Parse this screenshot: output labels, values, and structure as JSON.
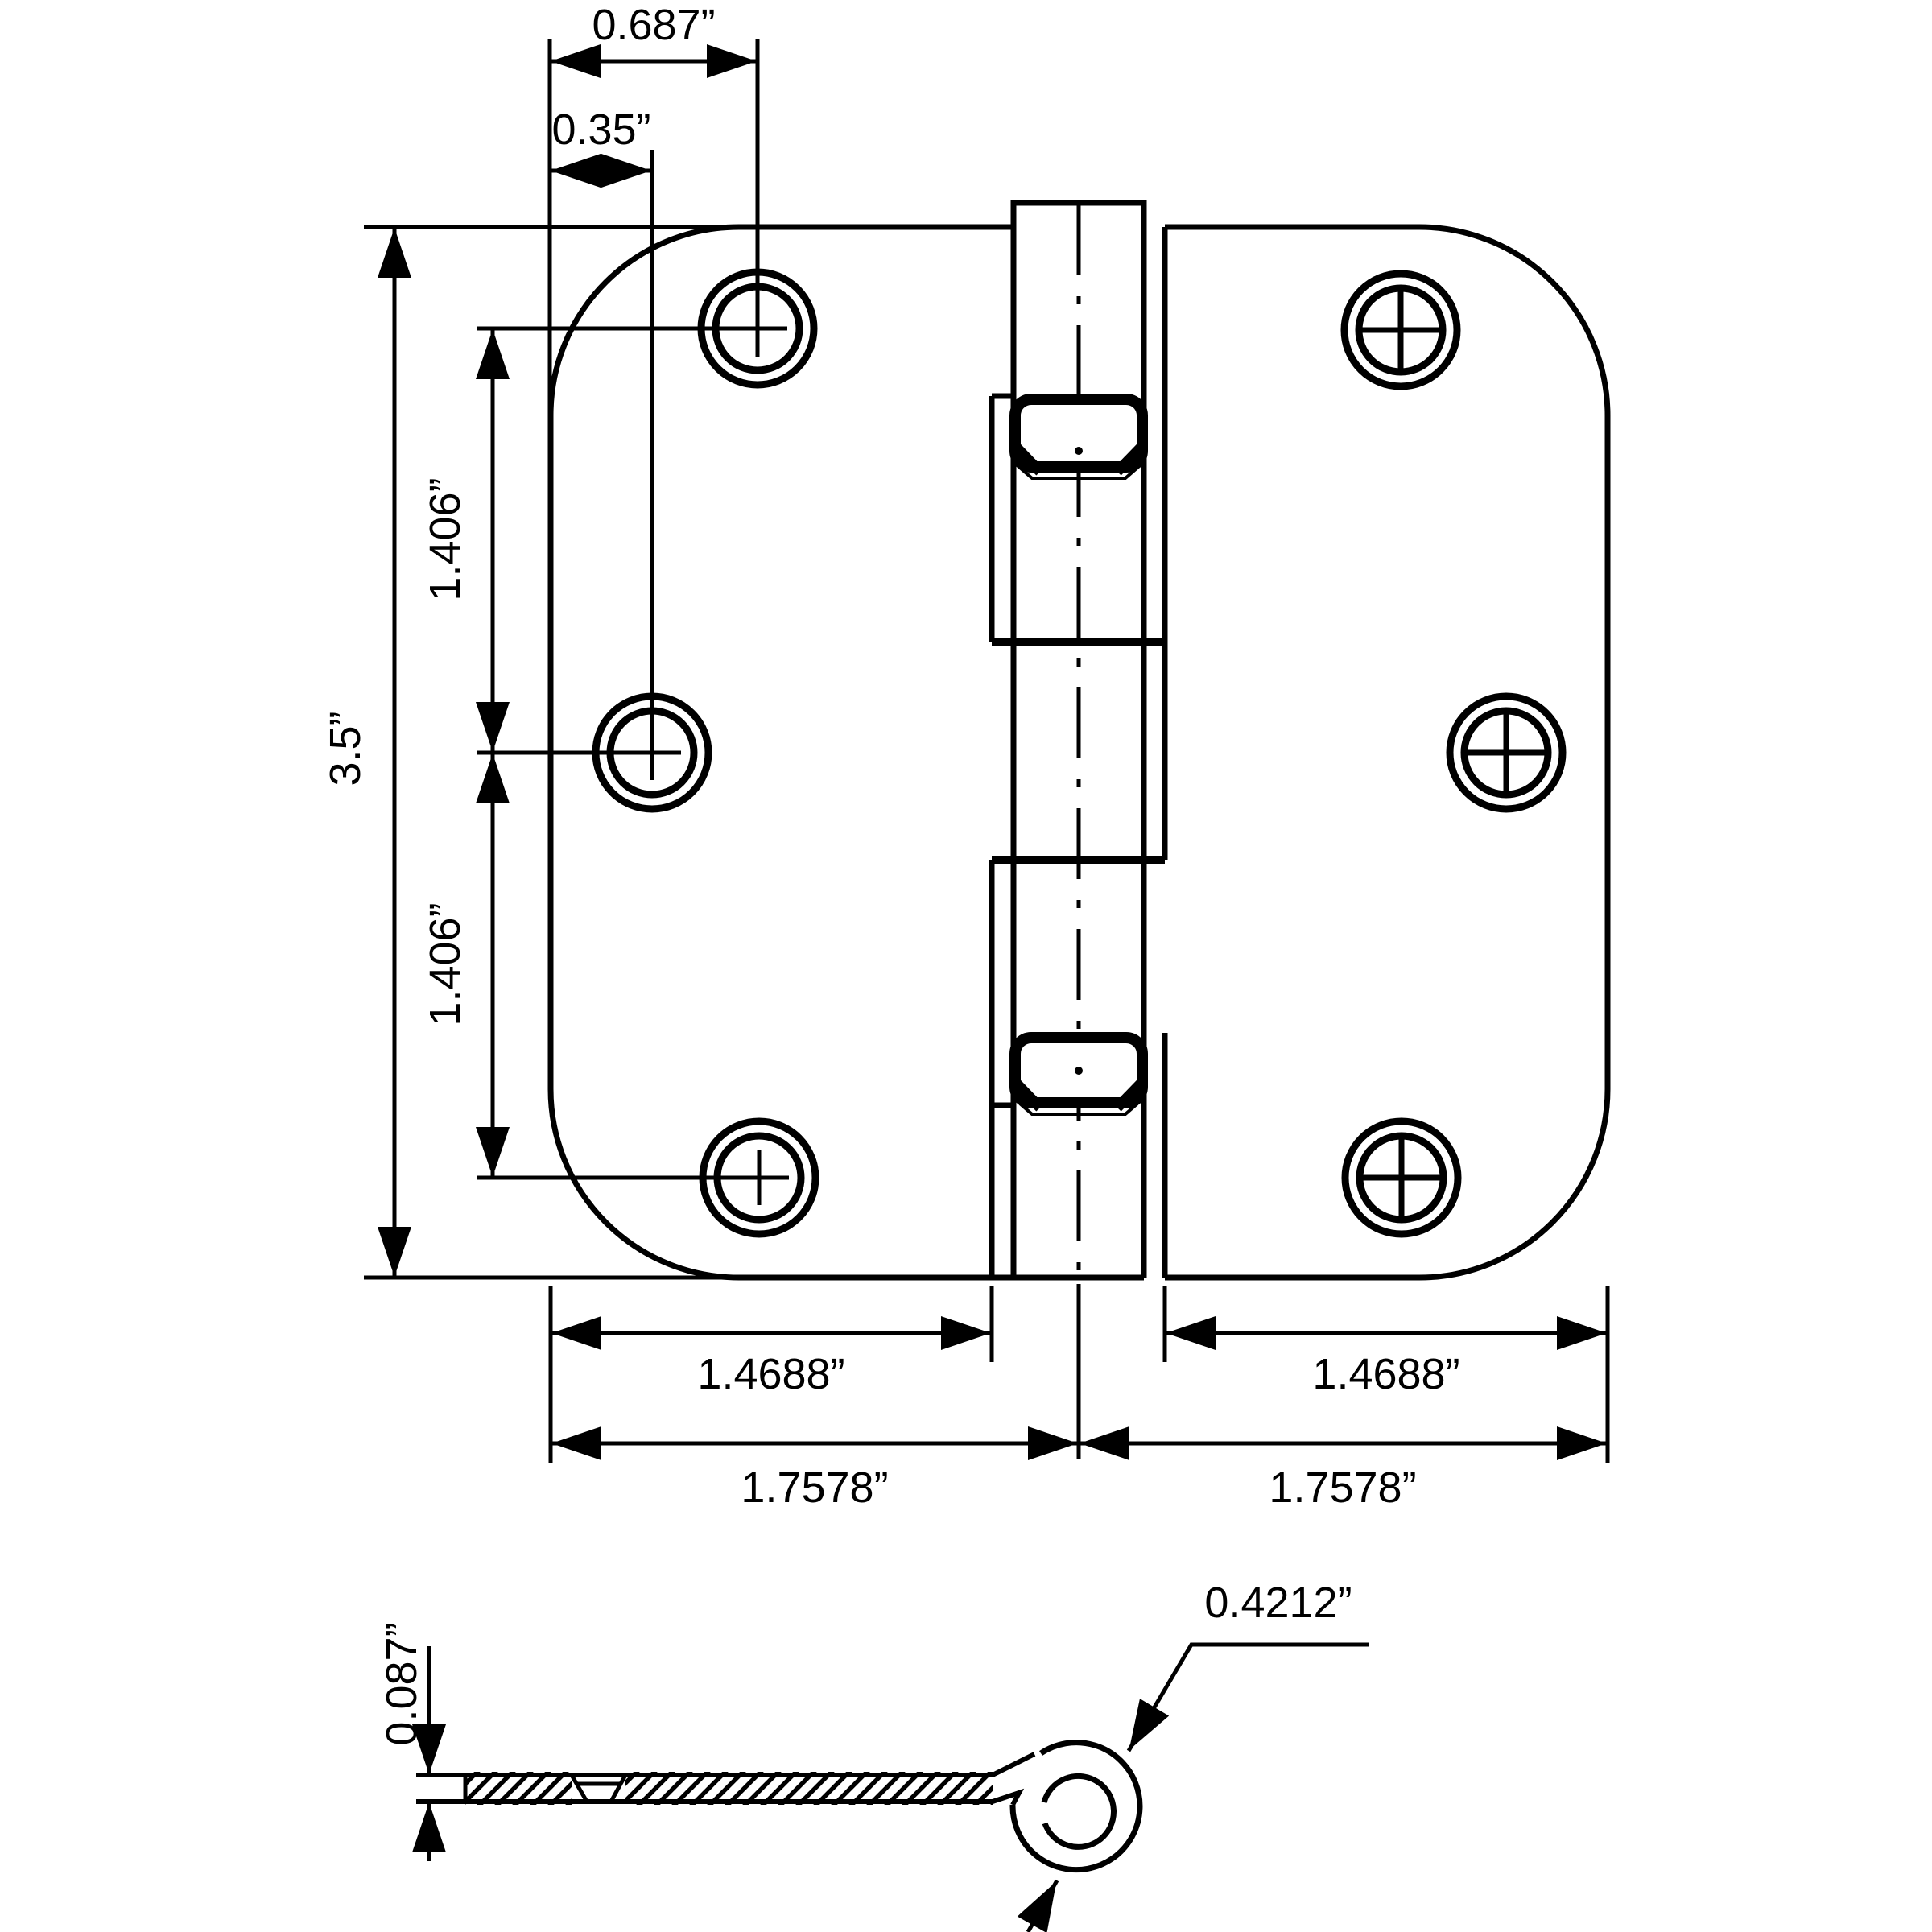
{
  "drawing": {
    "type": "technical-drawing",
    "subject": "door hinge, 5/8 inch radius corners, front view and section side view",
    "ink_color": "#000000",
    "background_color": "#ffffff",
    "front_view": {
      "dims": {
        "corner_hole_offset": "0.687”",
        "middle_hole_offset": "0.35”",
        "overall_height": "3.5”",
        "hole_spacing_upper": "1.406”",
        "hole_spacing_lower": "1.406”",
        "leaf_width_left": "1.4688”",
        "leaf_width_right": "1.4688”",
        "half_width_left": "1.7578”",
        "half_width_right": "1.7578”"
      },
      "features": {
        "screw_holes": 6,
        "knuckles": 5,
        "bearings": 2
      }
    },
    "side_view": {
      "dims": {
        "leaf_thickness": "0.087”",
        "knuckle_diameter": "0.4212”"
      }
    }
  }
}
